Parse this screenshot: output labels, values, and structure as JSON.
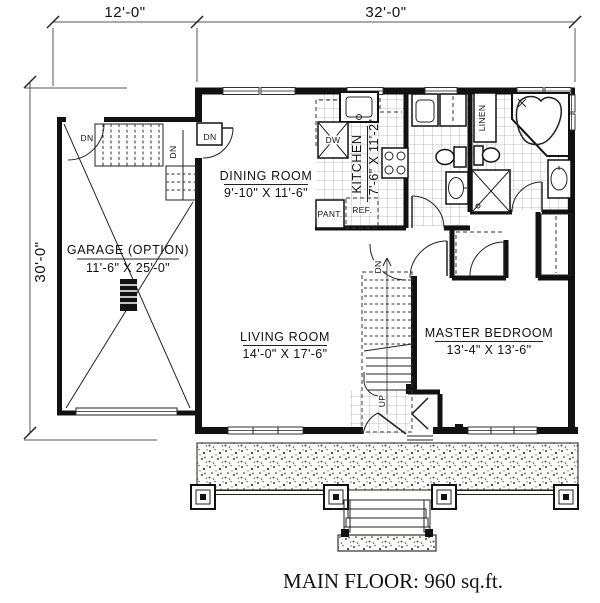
{
  "title": {
    "caption": "MAIN FLOOR: 960 sq.ft."
  },
  "dimensions": {
    "garage_width": "12'-0\"",
    "house_width": "32'-0\"",
    "house_depth": "30'-0\""
  },
  "rooms": {
    "garage": {
      "name": "GARAGE (OPTION)",
      "size": "11'-6\" X 25'-0\""
    },
    "dining_room": {
      "name": "DINING ROOM",
      "size": "9'-10\" X 11'-6\""
    },
    "kitchen": {
      "name": "KITCHEN",
      "size": "7'-6\" X 11'-2\""
    },
    "living_room": {
      "name": "LIVING ROOM",
      "size": "14'-0\" X 17'-6\""
    },
    "master_bedroom": {
      "name": "MASTER BEDROOM",
      "size": "13'-4\" X 13'-6\""
    }
  },
  "labels": {
    "down": "DN",
    "up": "UP",
    "pantry": "PANT.",
    "refrigerator": "REF.",
    "dishwasher": "DW",
    "linen": "LINEN"
  },
  "colors": {
    "wall": "#111111",
    "line": "#333333",
    "window_line": "#888888",
    "paper": "#ffffff"
  }
}
